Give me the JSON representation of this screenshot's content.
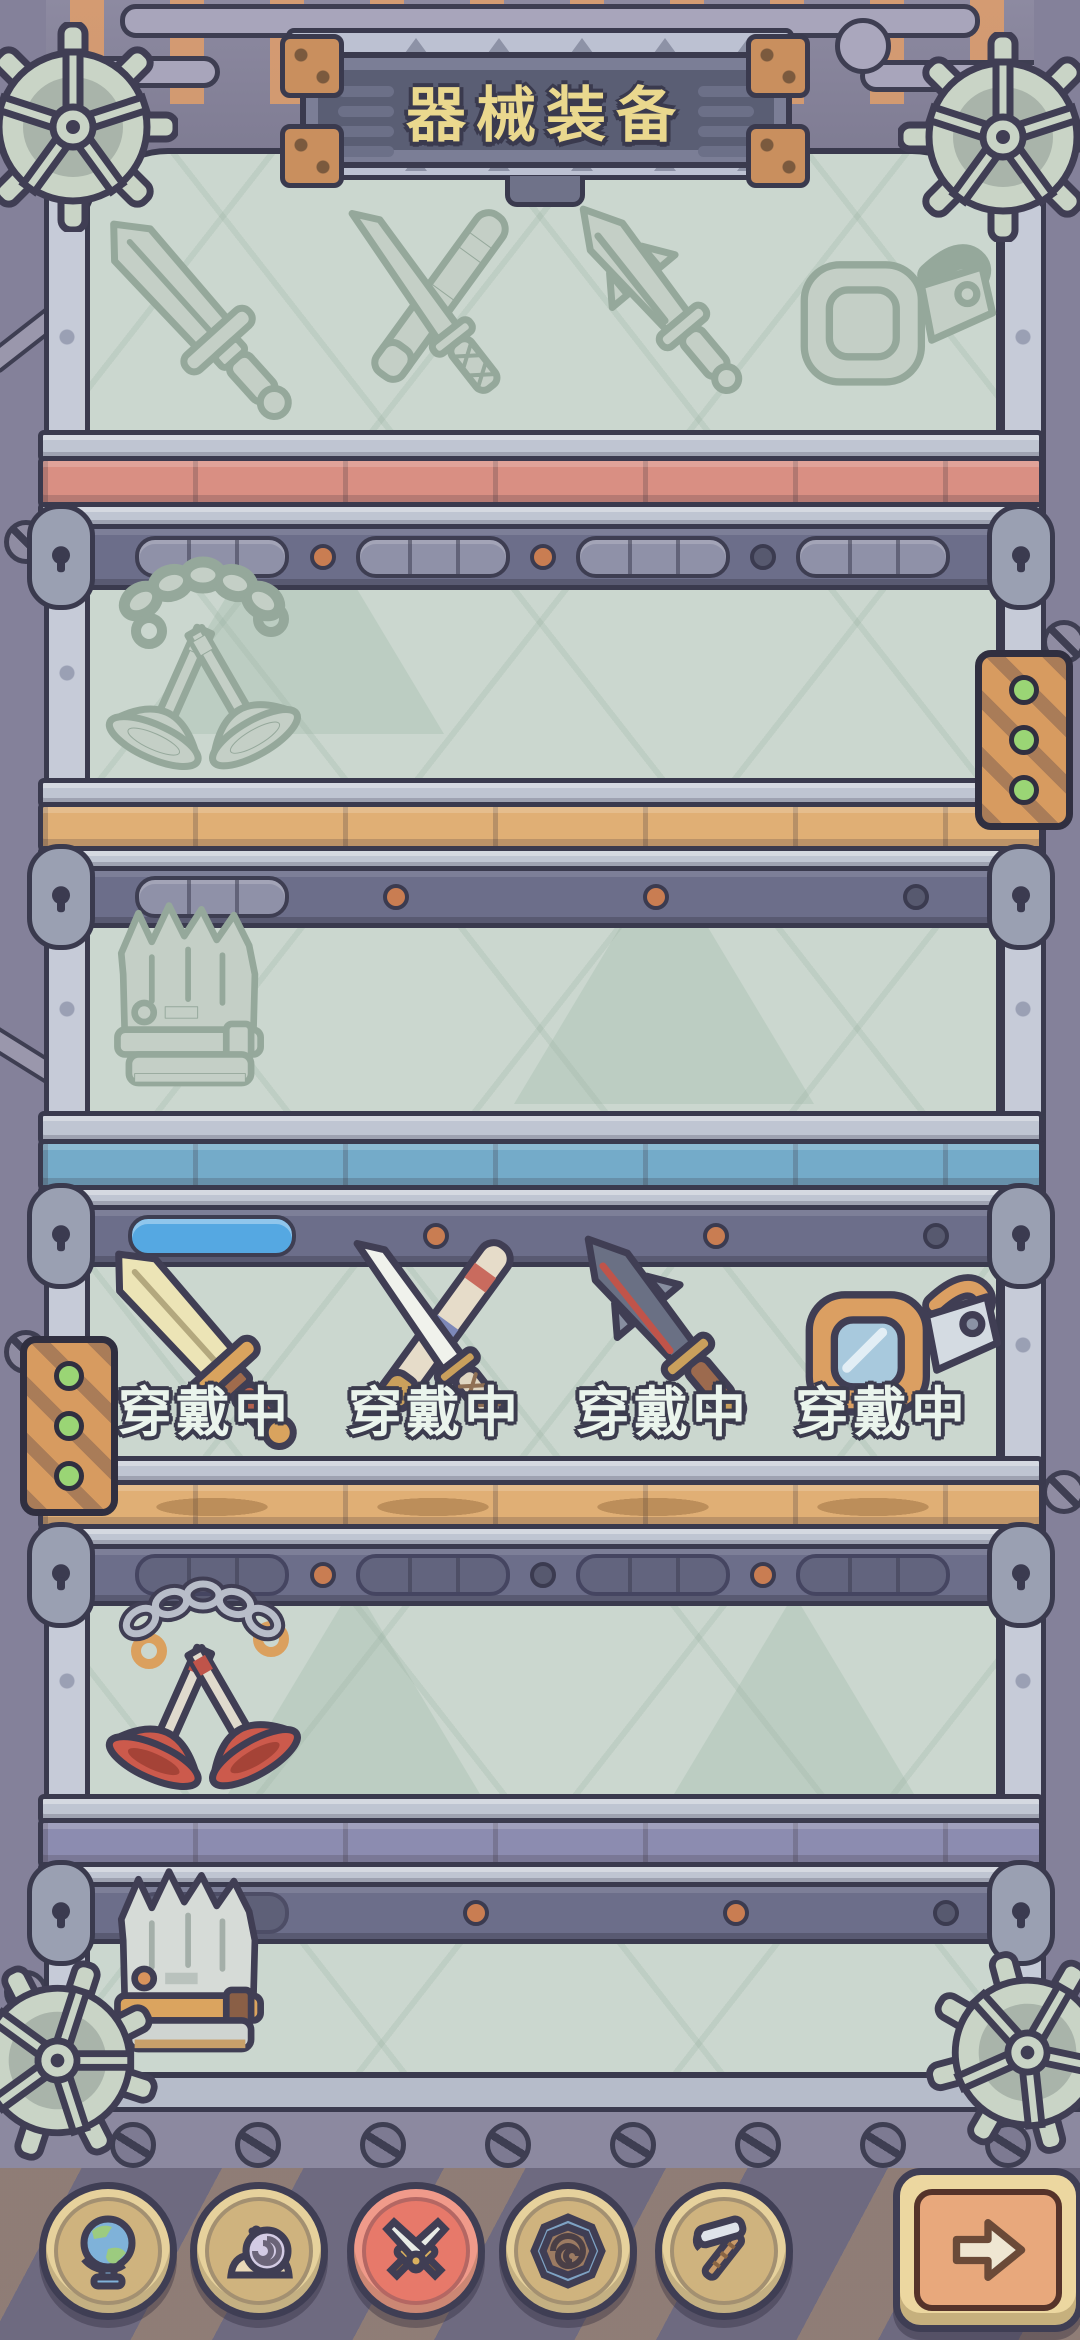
{
  "header": {
    "title": "器械装备"
  },
  "cabinet": {
    "wall_color": "#cbd7cf",
    "shelves": [
      {
        "id": 1,
        "state": "silhouette",
        "plank_color": "#d98f83",
        "items": [
          {
            "name": "greatsword",
            "owned": false
          },
          {
            "name": "katana",
            "owned": false
          },
          {
            "name": "rocket-dagger",
            "owned": false
          },
          {
            "name": "goggles",
            "owned": false
          }
        ],
        "gauges": [
          {
            "segments": 3,
            "filled": 0
          },
          {
            "segments": 3,
            "filled": 0
          },
          {
            "segments": 3,
            "filled": 0
          },
          {
            "segments": 3,
            "filled": 0
          }
        ]
      },
      {
        "id": 2,
        "state": "silhouette",
        "plank_color": "#e0af75",
        "items": [
          {
            "name": "chain-plungers",
            "owned": false
          }
        ],
        "gauges": [
          {
            "segments": 3,
            "filled": 0
          }
        ]
      },
      {
        "id": 3,
        "state": "silhouette",
        "plank_color": "#74abc9",
        "items": [
          {
            "name": "stone-crown",
            "owned": false
          }
        ],
        "gauges": [
          {
            "segments": 1,
            "filled": 1,
            "fill_color": "#55a8e2"
          }
        ]
      },
      {
        "id": 4,
        "state": "equipped",
        "plank_color": "#e0af75",
        "items": [
          {
            "name": "greatsword",
            "owned": true,
            "label": "穿戴中"
          },
          {
            "name": "katana",
            "owned": true,
            "label": "穿戴中"
          },
          {
            "name": "rocket-dagger",
            "owned": true,
            "label": "穿戴中"
          },
          {
            "name": "goggles",
            "owned": true,
            "label": "穿戴中"
          }
        ],
        "gauges": [
          {
            "segments": 3,
            "filled": 0
          },
          {
            "segments": 3,
            "filled": 0
          },
          {
            "segments": 3,
            "filled": 0
          },
          {
            "segments": 3,
            "filled": 0
          }
        ]
      },
      {
        "id": 5,
        "state": "owned",
        "plank_color": "#8c8cb0",
        "items": [
          {
            "name": "chain-plungers",
            "owned": true
          }
        ],
        "gauges": [
          {
            "segments": 1,
            "filled": 0
          }
        ]
      },
      {
        "id": 6,
        "state": "owned",
        "plank_color": null,
        "items": [
          {
            "name": "stone-crown",
            "owned": true
          }
        ],
        "gauges": []
      }
    ]
  },
  "nav": {
    "selected_color": "#e7796a",
    "items": [
      {
        "name": "world",
        "icon": "globe-icon",
        "selected": false
      },
      {
        "name": "snail",
        "icon": "snail-icon",
        "selected": false
      },
      {
        "name": "equipment",
        "icon": "crossed-swords-icon",
        "selected": true
      },
      {
        "name": "spiral",
        "icon": "spiral-icon",
        "selected": false
      },
      {
        "name": "workshop",
        "icon": "hammer-icon",
        "selected": false
      }
    ],
    "next_button": {
      "icon": "arrow-right-icon"
    }
  }
}
